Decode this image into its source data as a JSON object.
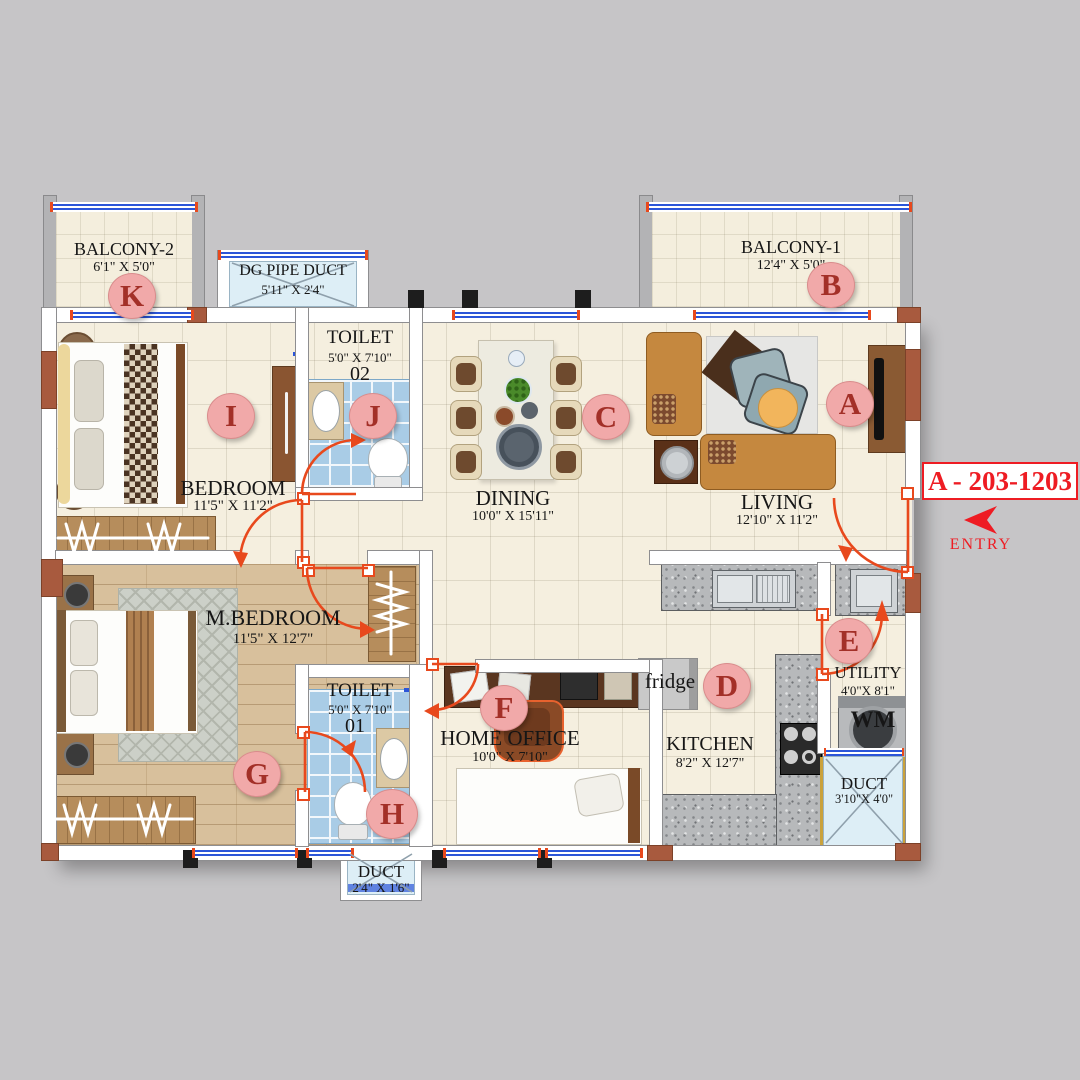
{
  "unit": {
    "code": "A - 203-1203",
    "entry_label": "ENTRY"
  },
  "rooms": {
    "balcony2": {
      "name": "BALCONY-2",
      "dims": "6'1\" X 5'0\"",
      "marker": "K"
    },
    "dg_pipe_duct": {
      "name": "DG PIPE DUCT",
      "dims": "5'11\" X 2'4\""
    },
    "balcony1": {
      "name": "BALCONY-1",
      "dims": "12'4\" X 5'0\"",
      "marker": "B"
    },
    "bedroom": {
      "name": "BEDROOM",
      "dims": "11'5\" X 11'2\"",
      "marker": "I"
    },
    "toilet2": {
      "name": "TOILET",
      "dims": "5'0\" X 7'10\"",
      "number": "02",
      "marker": "J"
    },
    "dining": {
      "name": "DINING",
      "dims": "10'0\" X 15'11\"",
      "marker": "C"
    },
    "living": {
      "name": "LIVING",
      "dims": "12'10\" X 11'2\"",
      "marker": "A"
    },
    "master_bedroom": {
      "name": "M.BEDROOM",
      "dims": "11'5\" X 12'7\"",
      "marker": "G"
    },
    "toilet1": {
      "name": "TOILET",
      "dims": "5'0\" X 7'10\"",
      "number": "01",
      "marker": "H"
    },
    "home_office": {
      "name": "HOME OFFICE",
      "dims": "10'0\" X 7'10\"",
      "marker": "F"
    },
    "kitchen": {
      "name": "KITCHEN",
      "dims": "8'2\" X 12'7\"",
      "marker": "D"
    },
    "utility": {
      "name": "UTILITY",
      "dims": "4'0\"X 8'1\"",
      "marker": "E"
    },
    "duct_utility": {
      "name": "DUCT",
      "dims": "3'10\"X 4'0\""
    },
    "duct_bottom": {
      "name": "DUCT",
      "dims": "2'4\" X 1'6\""
    }
  },
  "appliances": {
    "fridge": "fridge",
    "washing_machine": "WM"
  },
  "colors": {
    "door_swing": "#e8491d",
    "entry_red": "#ee1c23",
    "marker_pink": "#f1a9a9",
    "window_blue": "#2b55d8"
  }
}
